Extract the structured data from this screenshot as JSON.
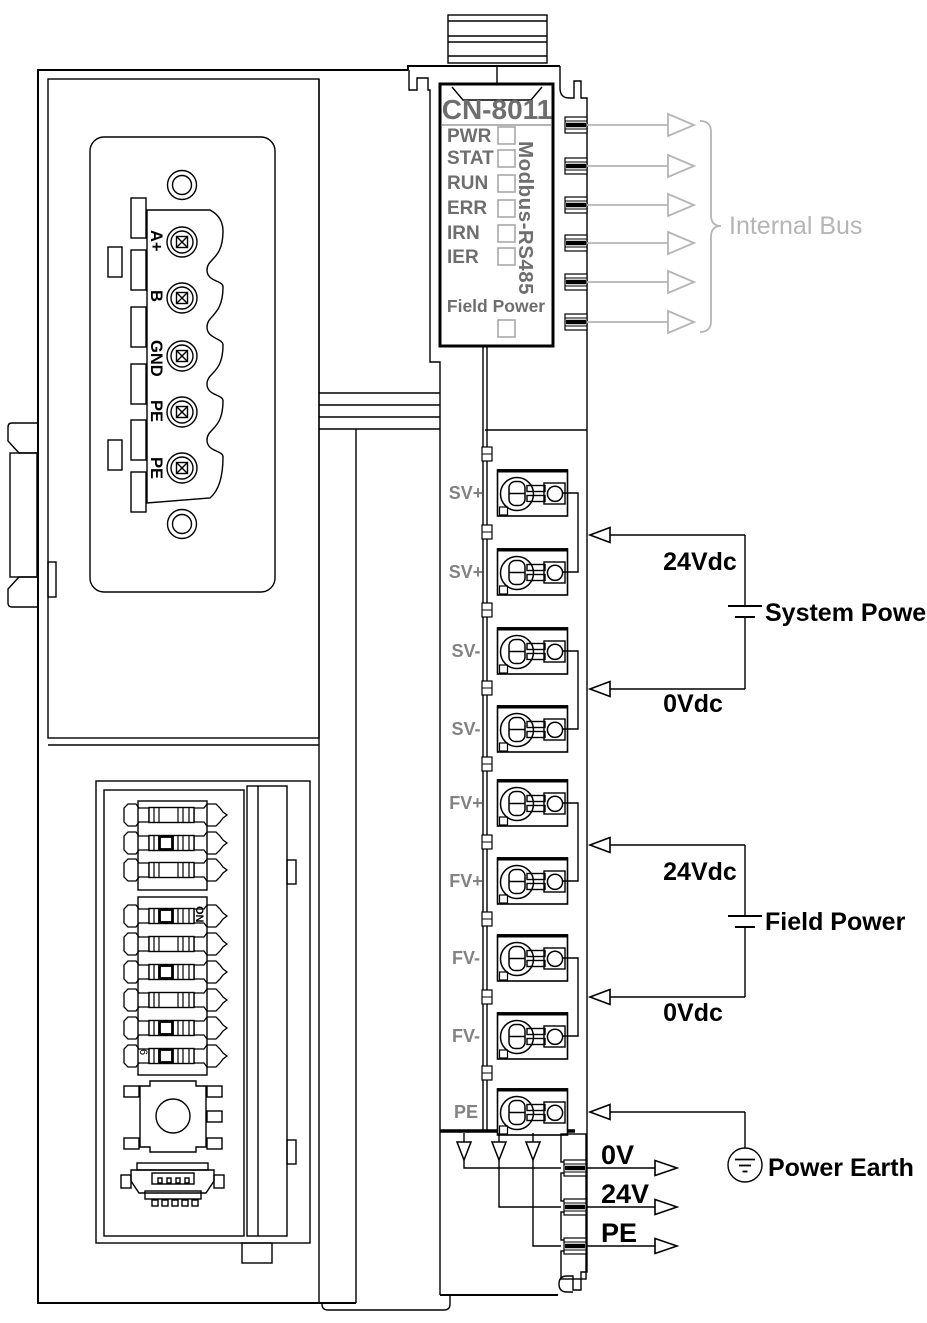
{
  "module": {
    "model": "CN-8011",
    "interface": "Modbus-RS485",
    "led_labels": [
      "PWR",
      "STAT",
      "RUN",
      "ERR",
      "IRN",
      "IER"
    ],
    "field_power_label": "Field Power"
  },
  "internal_bus": {
    "label": "Internal Bus"
  },
  "rs485_terminals": [
    "A+",
    "B",
    "GND",
    "PE",
    "PE"
  ],
  "power_terminal_labels": [
    "SV+",
    "SV+",
    "SV-",
    "SV-",
    "FV+",
    "FV+",
    "FV-",
    "FV-",
    "PE"
  ],
  "system_power": {
    "plus": "24Vdc",
    "minus": "0Vdc",
    "name": "System Power"
  },
  "field_power": {
    "plus": "24Vdc",
    "minus": "0Vdc",
    "name": "Field Power"
  },
  "power_earth_label": "Power Earth",
  "feedthrough_labels": [
    "0V",
    "24V",
    "PE"
  ],
  "dip": {
    "on": "ON",
    "six": "6"
  },
  "colors": {
    "line": "#000000",
    "panel_text_gray": "#6e6e6e",
    "terminal_text_gray": "#828282",
    "bus_gray": "#b5b5b5"
  }
}
